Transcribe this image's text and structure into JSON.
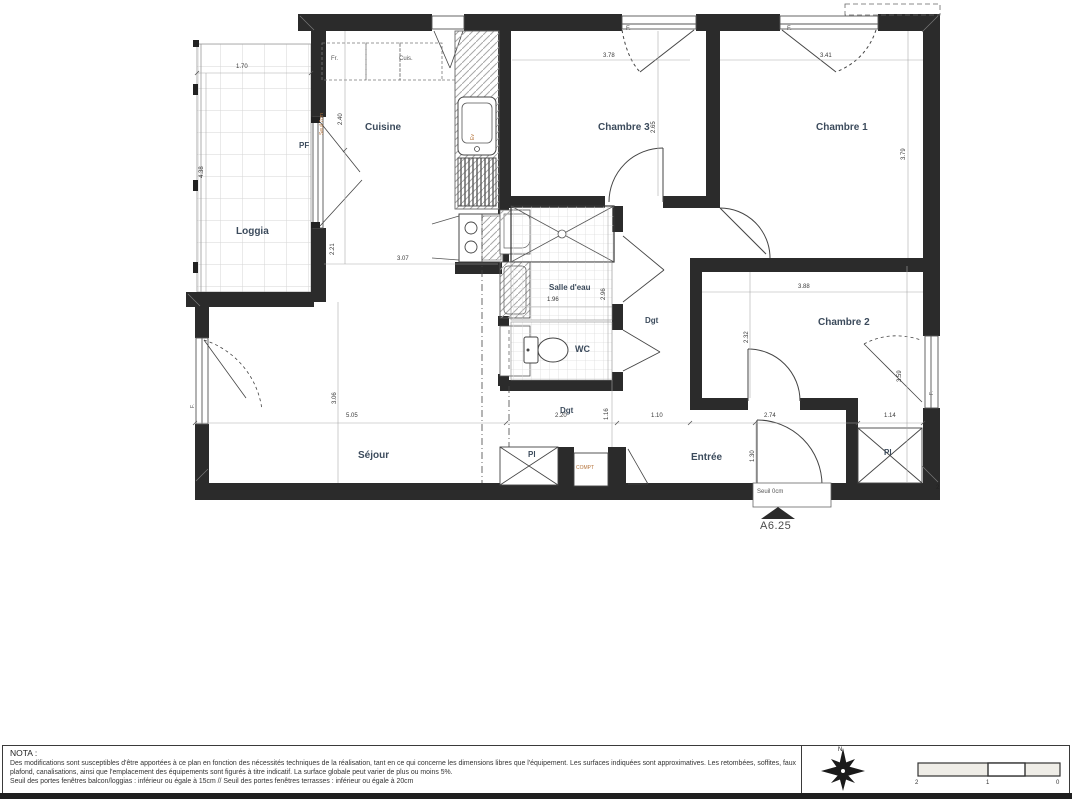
{
  "plan": {
    "rooms": {
      "loggia": "Loggia",
      "cuisine": "Cuisine",
      "chambre3": "Chambre 3",
      "chambre1": "Chambre 1",
      "salle_eau": "Salle d'eau",
      "wc": "WC",
      "dgt_upper": "Dgt",
      "chambre2": "Chambre 2",
      "sejour": "Séjour",
      "dgt_lower": "Dgt",
      "entree": "Entrée",
      "pl_center": "Pl",
      "pl_right": "Pl",
      "pf": "PF",
      "comp": "COMPT"
    },
    "appliances": {
      "fridge": "Fr.",
      "cooker": "Cuis.",
      "sink": "Ev"
    },
    "windows": {
      "f1": "F.",
      "f2": "F.",
      "f3": "F.",
      "f4": "F."
    },
    "dims": {
      "loggia_w": "1.70",
      "loggia_h": "4.38",
      "cuisine_h_top": "2.40",
      "cuisine_h_bottom": "2.21",
      "cuisine_w": "3.07",
      "ch3_w": "3.78",
      "ch3_h": "2.65",
      "ch1_w": "3.41",
      "ch1_h": "3.79",
      "sde_w": "1.96",
      "sde_h": "2.96",
      "ch2_w": "3.88",
      "ch2_h_left": "2.32",
      "ch2_h_right": "3.59",
      "sejour_h": "3.06",
      "sejour_w": "5.05",
      "hall_w": "2.20",
      "hall_w2": "1.10",
      "hall_h": "1.16",
      "entree_w": "2.74",
      "pl_w": "1.14",
      "entree_h": "1.30"
    },
    "annotations": {
      "seuil_balcon": "Seuil 7cm",
      "seuil_entree": "Seuil 0cm",
      "ref": "A6.25",
      "corner_mark": "2"
    }
  },
  "nota": {
    "title": "NOTA :",
    "body": "Des modifications sont susceptibles d'être apportées à ce plan en fonction des nécessités techniques de la réalisation, tant en ce qui concerne les dimensions libres que l'équipement. Les surfaces indiquées sont approximatives. Les retombées, soffites, faux plafond, canalisations, ainsi que l'emplacement des équipements sont figurés à titre indicatif. La surface globale peut varier de plus ou moins 5%.",
    "seuil_line": "Seuil des portes fenêtres balcon/loggias : inférieur ou égale à 15cm // Seuil des portes fenêtres terrasses :  inférieur ou égale à 20cm"
  },
  "legend": {
    "north": "N",
    "scale": {
      "t2": "2",
      "t1": "1",
      "t0": "0"
    }
  }
}
